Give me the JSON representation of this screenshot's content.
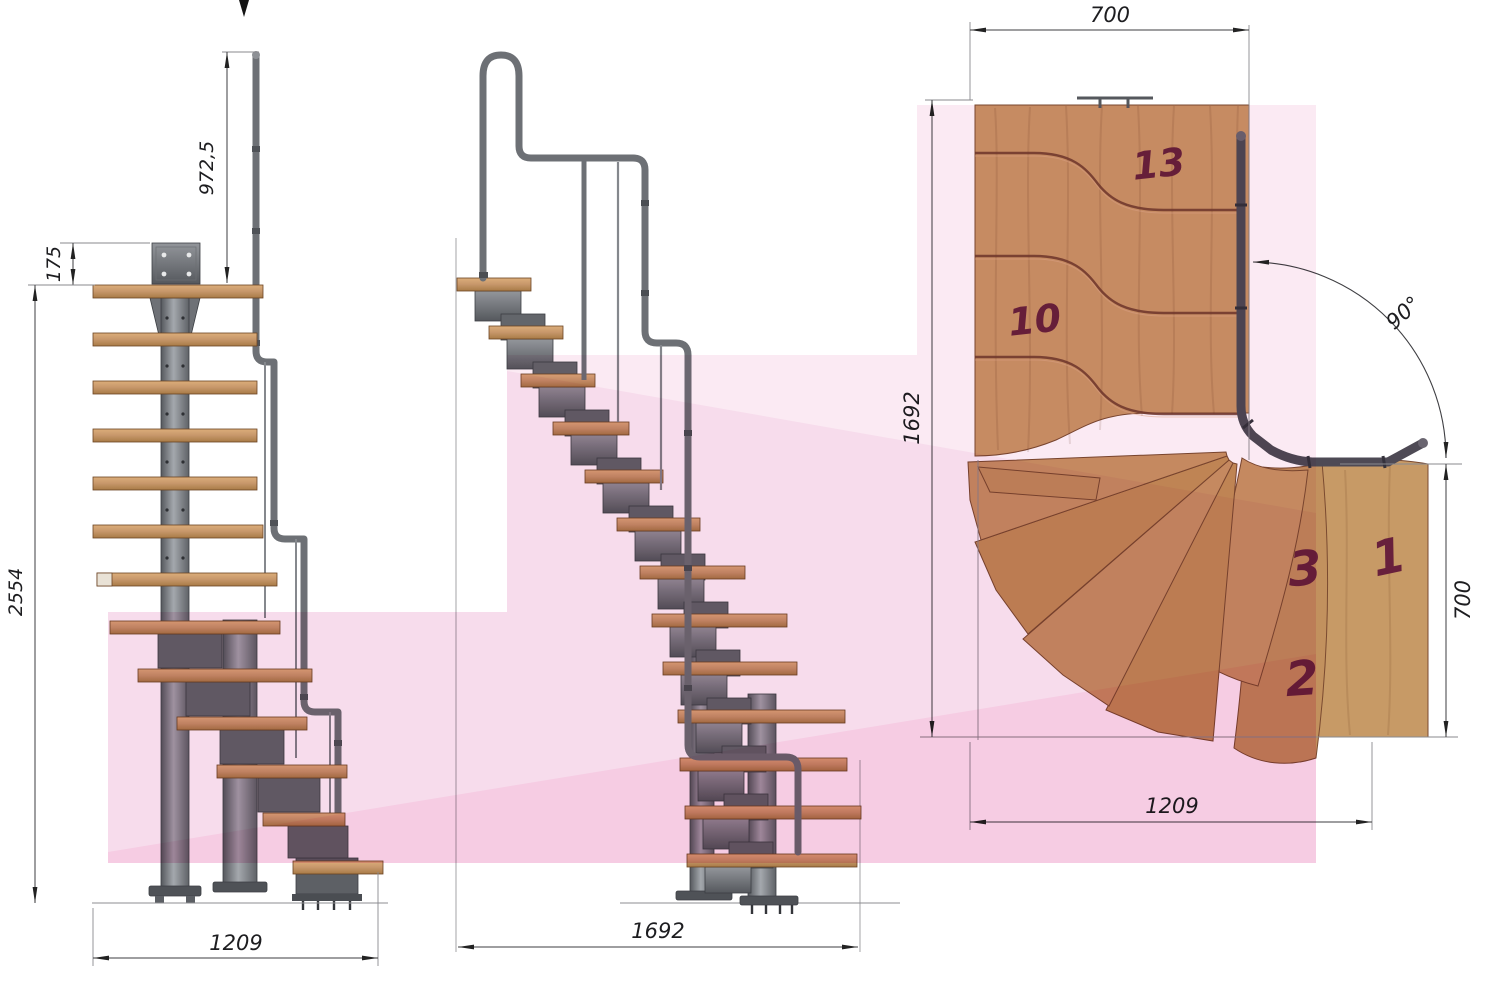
{
  "drawing": {
    "front_view": {
      "dim_rail_height": "972,5",
      "dim_bracket_offset": "175",
      "dim_total_height": "2554",
      "dim_width": "1209"
    },
    "side_view": {
      "dim_length": "1692"
    },
    "plan_view": {
      "dim_width_top": "700",
      "dim_length_left": "1692",
      "dim_width_right": "700",
      "dim_width_bottom": "1209",
      "dim_turn_angle": "90°",
      "step_labels": {
        "step_13": "13",
        "step_10": "10",
        "step_3": "3",
        "step_1": "1",
        "step_2": "2"
      }
    },
    "colors": {
      "highlight_pink": "#f6cce3",
      "wood": "#c99767",
      "steel": "#7d8083",
      "step_label": "#68203c"
    }
  }
}
